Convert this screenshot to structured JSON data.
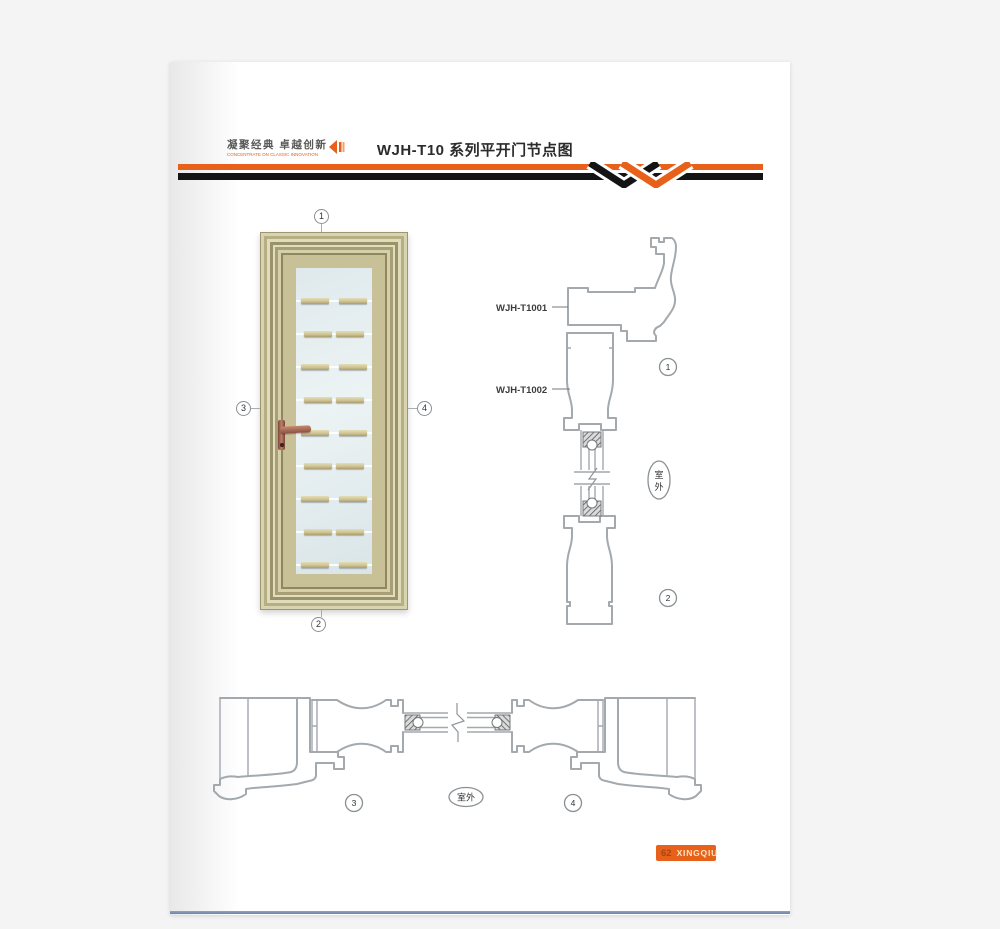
{
  "header": {
    "logo_cn": "凝聚经典  卓越创新",
    "logo_en": "CONCENTRATE ON CLASSIC INNOVATION",
    "title": "WJH-T10 系列平开门节点图"
  },
  "labels": {
    "profile1": "WJH-T1001",
    "profile2": "WJH-T1002",
    "outdoor": "室外",
    "outdoor_char1": "室",
    "outdoor_char2": "外"
  },
  "callouts": {
    "n1": "1",
    "n2": "2",
    "n3": "3",
    "n4": "4"
  },
  "footer": {
    "page_number": "62",
    "brand": "XINGQIU"
  },
  "colors": {
    "accent_orange": "#e8611a",
    "band_black": "#141414",
    "footer_line_blue": "#7e93b3",
    "door_champagne": "#c2bb92",
    "glass_blue": "#e3ecee",
    "drawing_gray": "#a3a9ad"
  }
}
